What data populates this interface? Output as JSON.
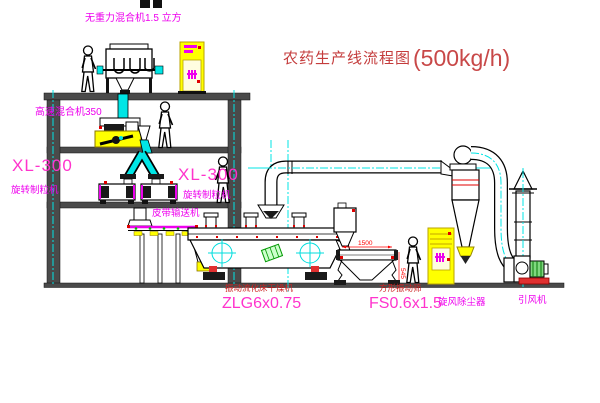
{
  "title": {
    "text": "农药生产线流程图",
    "capacity": "(500kg/h)"
  },
  "labels": {
    "gravity_mixer": "无重力混合机1.5 立方",
    "high_speed_mixer": "高速混合机350",
    "granulator_left_model": "XL-300",
    "granulator_left_name": "旋转制粒机",
    "granulator_right_model": "XL-300",
    "granulator_right_name": "旋转制粒机",
    "belt_conveyor": "皮带输送机",
    "dryer_name": "振动流化床干燥机",
    "dryer_model": "ZLG6x0.75",
    "sieve_name": "方形振动筛",
    "sieve_model": "FS0.6x1.5",
    "cyclone_name": "旋风除尘器",
    "fan_name": "引风机"
  },
  "dimensions": {
    "sieve_length": "1500",
    "sieve_height": "545"
  },
  "colors": {
    "magenta_label": "#ee00ee",
    "pink_model": "#ff33cc",
    "red_machine_label": "#cc2222",
    "title_red": "#c43c3c",
    "centerline_cyan": "#00e5e5",
    "cabinet_yellow": "#ffff00"
  }
}
